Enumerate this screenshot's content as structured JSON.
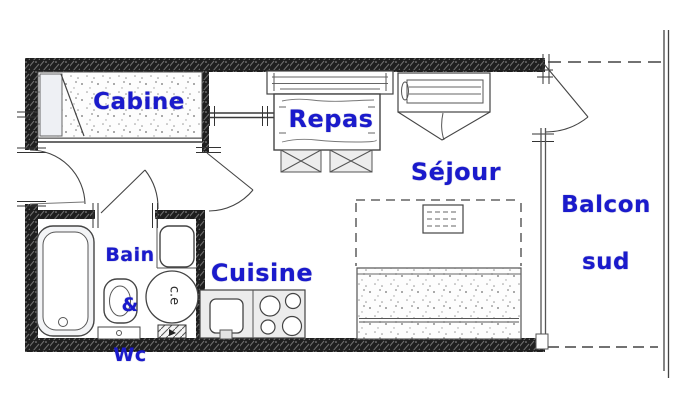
{
  "plan": {
    "rooms": {
      "cabine": {
        "label": "Cabine"
      },
      "repas": {
        "label": "Repas"
      },
      "sejour": {
        "label": "Séjour"
      },
      "balcon": {
        "label_line1": "Balcon",
        "label_line2": "sud"
      },
      "bain": {
        "label_line1": "Bain",
        "label_line2": "&",
        "label_line3": "Wc"
      },
      "cuisine": {
        "label": "Cuisine"
      }
    },
    "equipment": {
      "water_heater_label": "c.e"
    },
    "colors": {
      "label_blue": "#1a1acc",
      "line": "#3a3a3a",
      "wall": "#1c1c1c",
      "paper": "#ffffff"
    },
    "icons": [
      "bunk-bed",
      "bench-seat",
      "dining-table",
      "folding-chair",
      "sofa-bed",
      "pullout-bed",
      "side-table",
      "bathtub",
      "toilet",
      "washbasin",
      "water-heater",
      "kitchen-sink",
      "cooktop",
      "entry-door",
      "cabin-door",
      "bathroom-door",
      "balcony-door",
      "window-wall",
      "balcony-railing"
    ]
  }
}
